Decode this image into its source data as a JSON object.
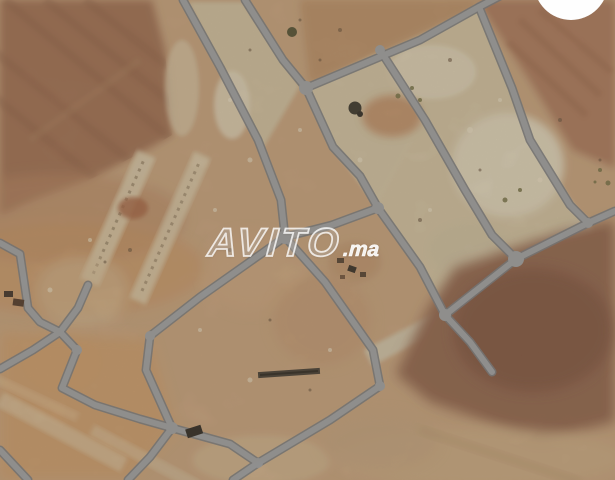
{
  "watermark": {
    "brand": "AVITO",
    "suffix": ".ma"
  },
  "colors": {
    "base": "#c5a078",
    "field": "#9c6b4b",
    "field_stripe": "#8a5c3f",
    "orange_soil": "#cf9a63",
    "pale_strip": "#dbcfae",
    "plot_cream": "#d2c4a2",
    "plot_bright": "#e0d6ba",
    "red_strip": "#a87454",
    "brown_field": "#8c5f45",
    "brown_core": "#7a4e37",
    "pale_band": "#d3cbb0",
    "road_edge": "#74787b",
    "road_core": "#9a9ea1",
    "badge": "#fefefe",
    "dark_object": "#35291e",
    "watermark_fill": "rgba(255,255,255,0.22)",
    "watermark_stroke": "rgba(255,255,255,0.78)",
    "watermark_suffix": "rgba(255,255,255,0.9)"
  }
}
